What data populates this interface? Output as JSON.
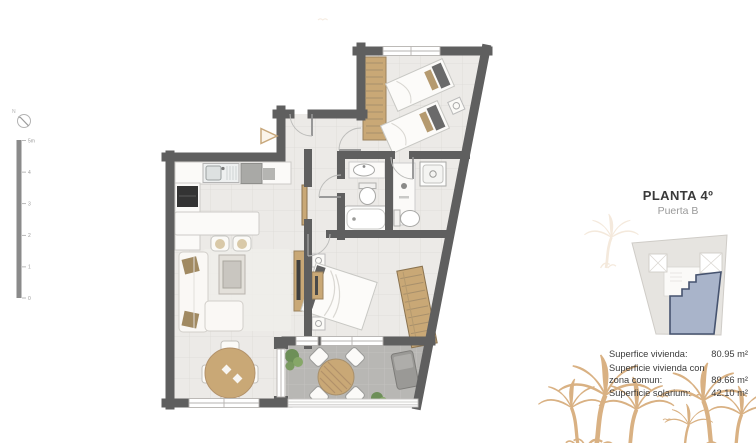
{
  "panel": {
    "title": "PLANTA 4º",
    "subtitle": "Puerta B",
    "areas": {
      "rows": [
        {
          "label": "Superfice vivienda:",
          "value": "80.95 m²"
        },
        {
          "label": "Superficie vivienda con zona comun:",
          "value": "89.66 m²"
        },
        {
          "label": "Superficie solarium:",
          "value": "42.10 m²"
        }
      ]
    }
  },
  "compass": {
    "label": "N"
  },
  "scalebar": {
    "labels": [
      "5m",
      "4",
      "3",
      "2",
      "1",
      "0"
    ]
  },
  "colors": {
    "wall": "#5f5f5f",
    "floor_tile": "#eceae7",
    "terrace_floor": "#b8b7b4",
    "wood": "#c9a876",
    "unit_highlight": "#a9b4ca",
    "unit_outline": "#46536f",
    "palm": "#d9b183"
  }
}
